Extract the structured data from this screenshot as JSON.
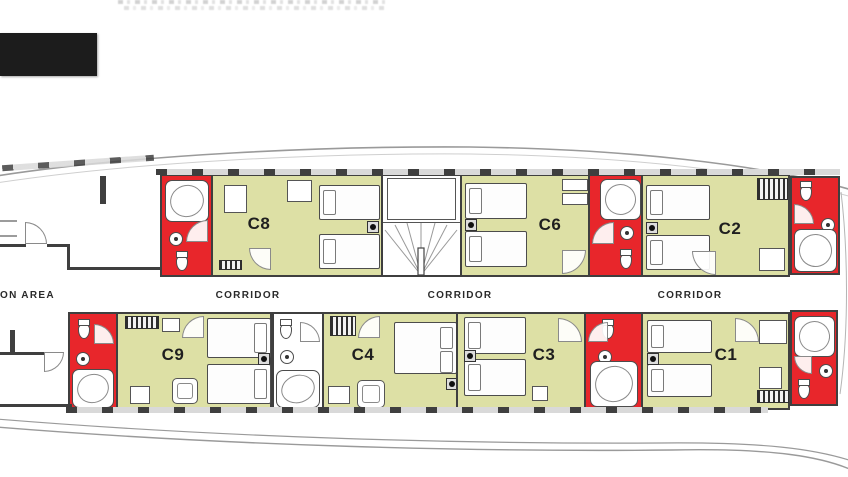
{
  "plan": {
    "area_label": "ON AREA",
    "corridors": [
      {
        "label": "CORRIDOR"
      },
      {
        "label": "CORRIDOR"
      },
      {
        "label": "CORRIDOR"
      }
    ],
    "cabins": [
      {
        "id": "c8",
        "label": "C8"
      },
      {
        "id": "c6",
        "label": "C6"
      },
      {
        "id": "c2",
        "label": "C2"
      },
      {
        "id": "c9",
        "label": "C9"
      },
      {
        "id": "c4",
        "label": "C4"
      },
      {
        "id": "c3",
        "label": "C3"
      },
      {
        "id": "c1",
        "label": "C1"
      }
    ]
  },
  "colors": {
    "cabin_fill": "#dde0a5",
    "bathroom_fill": "#e8262b",
    "wall": "#3f3f3f",
    "hull_line": "#9a9a9a",
    "black_box": "#1c1c1c"
  }
}
